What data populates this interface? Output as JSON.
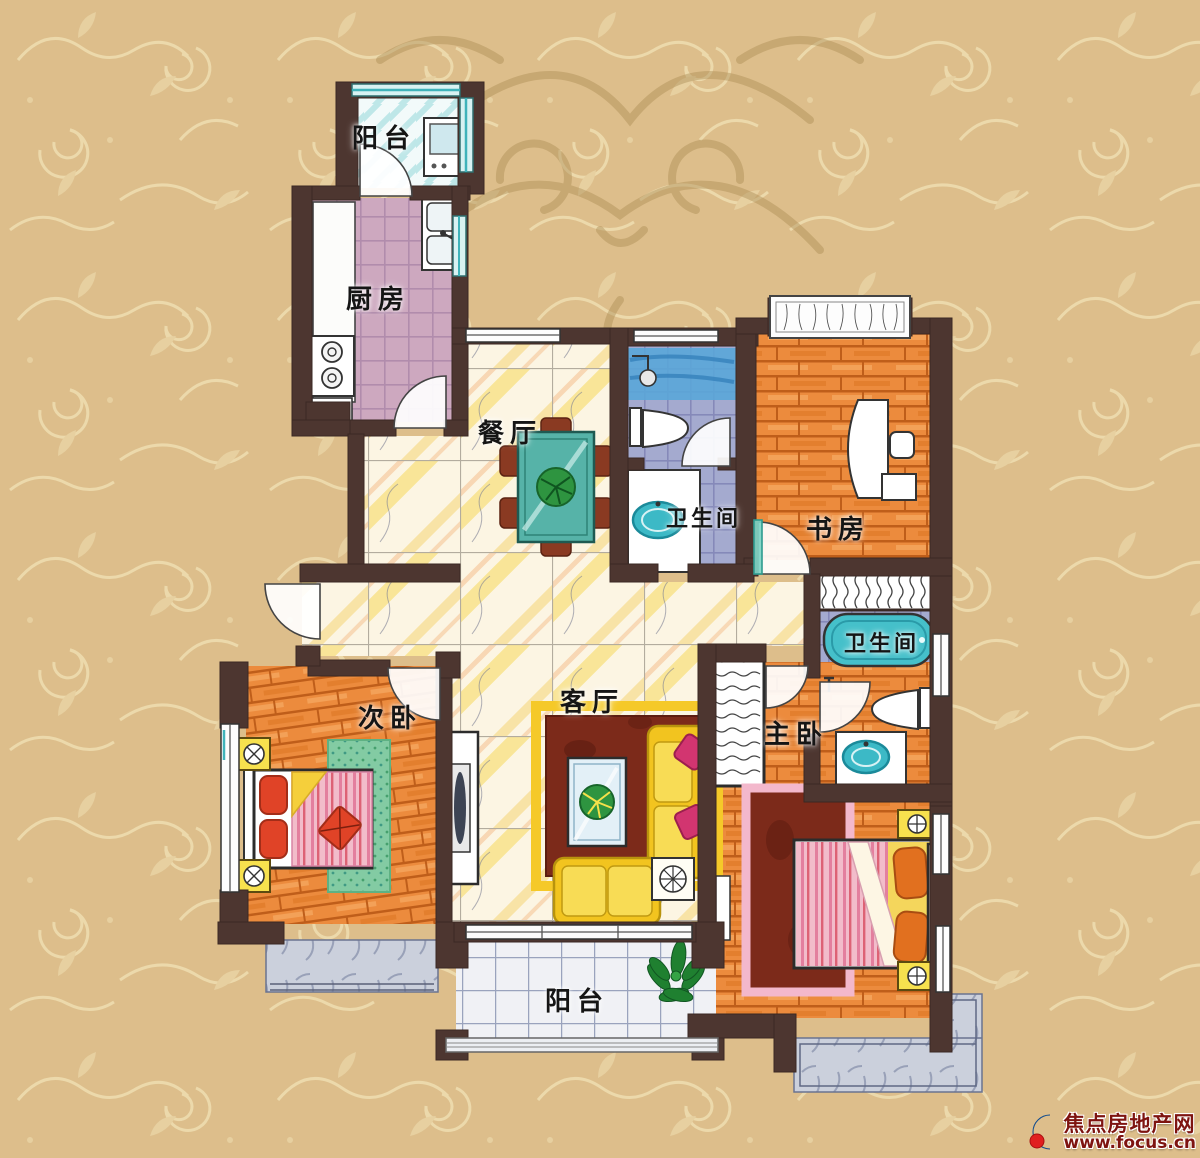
{
  "page": {
    "type": "residential-floor-plan",
    "language": "zh-CN"
  },
  "rooms": [
    {
      "id": "balcony-top",
      "label": "阳台"
    },
    {
      "id": "kitchen",
      "label": "厨房"
    },
    {
      "id": "dining-room",
      "label": "餐厅"
    },
    {
      "id": "bathroom-1",
      "label": "卫生间"
    },
    {
      "id": "study",
      "label": "书房"
    },
    {
      "id": "bathroom-2",
      "label": "卫生间"
    },
    {
      "id": "living-room",
      "label": "客厅"
    },
    {
      "id": "second-bedroom",
      "label": "次卧"
    },
    {
      "id": "master-bedroom",
      "label": "主卧"
    },
    {
      "id": "balcony-bottom",
      "label": "阳台"
    }
  ],
  "watermark": {
    "site_name": "焦点房地产网",
    "site_url": "www.focus.cn",
    "text_color": "#7e1410",
    "logo_blue": "#1b66b8",
    "logo_red": "#e01f1f"
  },
  "palette": {
    "background_tan": "#ddbe8b",
    "swirl_light": "#ecd9ab",
    "flourish_dark": "#a98a52",
    "wall_brown": "#4d3630",
    "wood_floor_orange": "#ec8b3d",
    "kitchen_floor_mauve": "#cda8bf",
    "bath_floor_periwinkle": "#a4aacf",
    "hall_floor_yellow": "#f6d64d",
    "fixture_teal": "#3cb9c6",
    "sofa_yellow": "#f2c41f",
    "rug_dark_red": "#7c2a1a",
    "rug_green": "#83cba3",
    "pillow_magenta": "#d23570",
    "nightstand_yellow": "#f7e14e"
  }
}
